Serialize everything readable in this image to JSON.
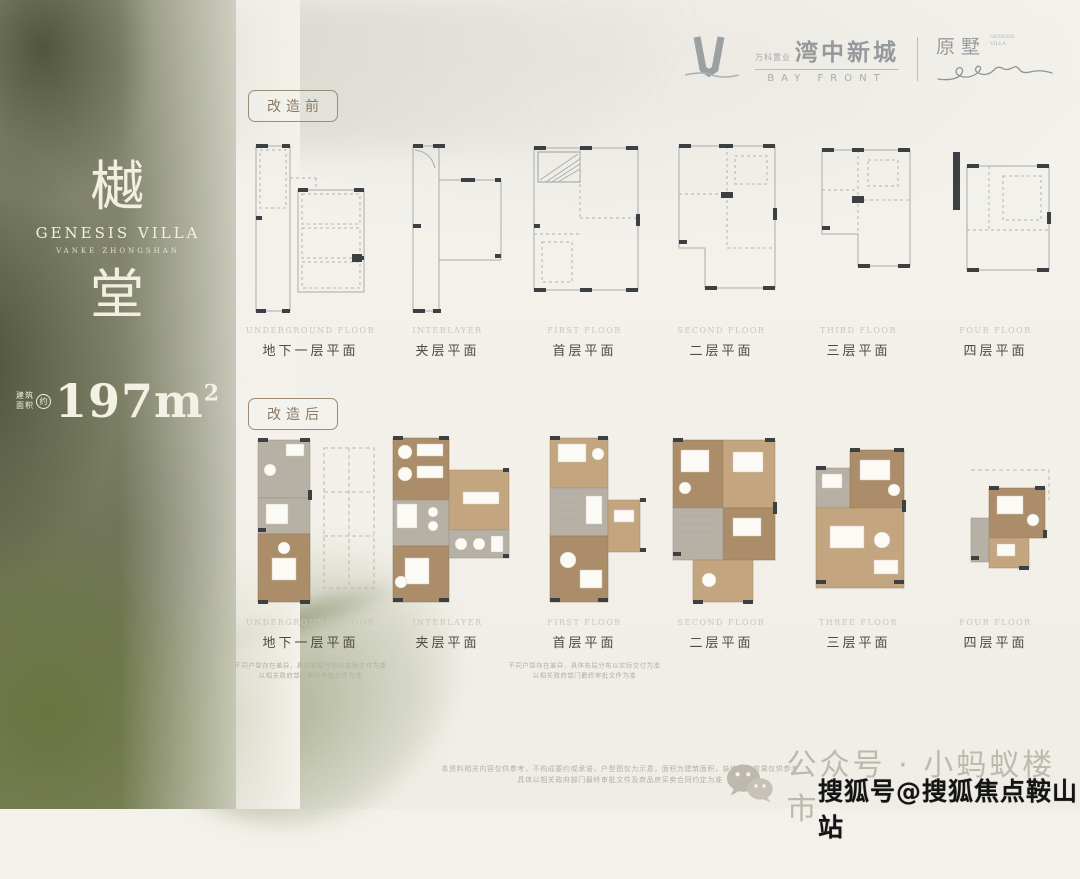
{
  "header": {
    "developer_small": "万科置业",
    "project_name_cn": "湾中新城",
    "project_name_en": "BAY FRONT",
    "sub_brand_cn": "原墅",
    "sub_brand_small": "GENESIS VILLA",
    "signature": "enru"
  },
  "sidebar": {
    "title_char_top": "樾",
    "title_en": "GENESIS VILLA",
    "title_sub": "VANKE ZHONGSHAN",
    "title_char_bottom": "堂",
    "area_prefix_line1": "建筑",
    "area_prefix_line2": "面积",
    "area_approx_mark": "约",
    "area_value": "197m",
    "area_sup": "2"
  },
  "sections": {
    "before": {
      "badge": "改造前",
      "plans": [
        {
          "en": "UNDERGROUND FLOOR",
          "cn": "地下一层平面"
        },
        {
          "en": "INTERLAYER",
          "cn": "夹层平面"
        },
        {
          "en": "FIRST FLOOR",
          "cn": "首层平面"
        },
        {
          "en": "SECOND FLOOR",
          "cn": "二层平面"
        },
        {
          "en": "THIRD FLOOR",
          "cn": "三层平面"
        },
        {
          "en": "FOUR FLOOR",
          "cn": "四层平面"
        }
      ]
    },
    "after": {
      "badge": "改造后",
      "plans": [
        {
          "en": "UNDERGROUND FLOOR",
          "cn": "地下一层平面",
          "note1": "不同户型存在差异，具体布局分布以实际交付为准",
          "note2": "以相关政府部门最终审批文件为准"
        },
        {
          "en": "INTERLAYER",
          "cn": "夹层平面"
        },
        {
          "en": "FIRST FLOOR",
          "cn": "首层平面",
          "note1": "不同户型存在差异，具体布局分布以实际交付为准",
          "note2": "以相关政府部门最终审批文件为准"
        },
        {
          "en": "SECOND FLOOR",
          "cn": "二层平面"
        },
        {
          "en": "THREE FLOOR",
          "cn": "三层平面"
        },
        {
          "en": "FOUR FLOOR",
          "cn": "四层平面"
        }
      ]
    }
  },
  "footer": {
    "disclaimer_line1": "本资料相关内容仅供参考，不构成要约或承诺，户型图仅为示意，面积为建筑面积，装修改造效果仅供参考",
    "disclaimer_line2": "具体以相关政府部门最终审批文件及商品房买卖合同约定为准",
    "wechat_label": "公众号 · 小蚂蚁楼市",
    "watermark": "搜狐号@搜狐焦点鞍山站"
  },
  "colors": {
    "paper": "#f3f1ea",
    "olive": "#7d8166",
    "wood": "#ab8d69",
    "badge_brown": "#8a7a66",
    "label_gray": "#c8c5bb",
    "label_dark": "#4f4b43"
  }
}
